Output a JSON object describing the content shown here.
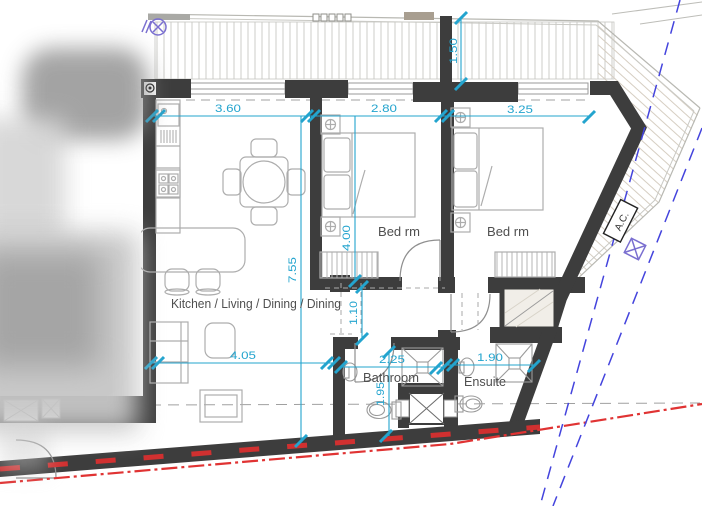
{
  "plan": {
    "rooms": {
      "kitchen_living_dining": "Kitchen / Living / Dining / Dining",
      "bedroom_1": "Bed rm",
      "bedroom_2": "Bed rm",
      "bathroom": "Bathroom",
      "ensuite": "Ensuite"
    },
    "equipment": {
      "ac_label": "A.C."
    },
    "dimensions_m": {
      "kitchen_width": "3.60",
      "bedroom1_width": "2.80",
      "bedroom2_width": "3.25",
      "balcony_depth": "1.50",
      "living_length": "7.55",
      "bedroom1_length": "4.00",
      "corridor_width": "1.10",
      "living_width": "4.05",
      "bathroom_width": "2.25",
      "ensuite_width": "1.90",
      "bathroom_length": "1.95"
    },
    "symbols": {
      "drain": "drain-symbol",
      "ac_unit": "ac-unit",
      "shaft": "shaft-cross-symbol"
    },
    "colors": {
      "wall": "#3d3d3d",
      "dimension_cyan": "#23a4ce",
      "boundary_red": "#e03333",
      "site_line_blue": "#4444dd",
      "utility_purple": "#7a6fd0",
      "furniture_gray": "#adadad",
      "label_gray": "#4f4f4f"
    }
  }
}
